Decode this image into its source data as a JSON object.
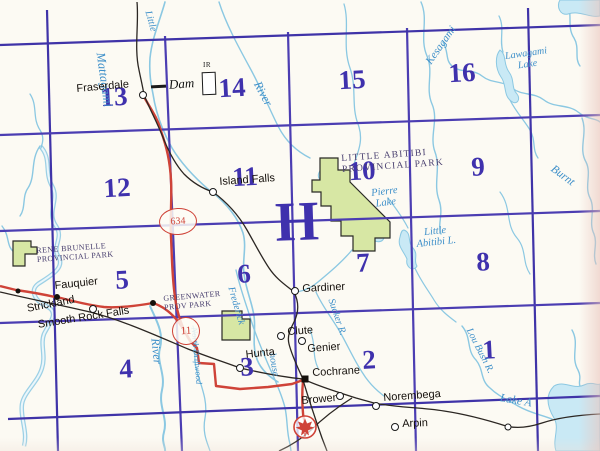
{
  "map": {
    "block_letter": "H",
    "grid_numbers": [
      {
        "label": "13",
        "x": 114,
        "y": 97
      },
      {
        "label": "14",
        "x": 232,
        "y": 88
      },
      {
        "label": "15",
        "x": 352,
        "y": 80
      },
      {
        "label": "16",
        "x": 462,
        "y": 73
      },
      {
        "label": "12",
        "x": 117,
        "y": 188
      },
      {
        "label": "11",
        "x": 245,
        "y": 177
      },
      {
        "label": "10",
        "x": 362,
        "y": 171
      },
      {
        "label": "9",
        "x": 478,
        "y": 167
      },
      {
        "label": "5",
        "x": 122,
        "y": 280
      },
      {
        "label": "6",
        "x": 244,
        "y": 274
      },
      {
        "label": "7",
        "x": 363,
        "y": 263
      },
      {
        "label": "8",
        "x": 483,
        "y": 262
      },
      {
        "label": "4",
        "x": 126,
        "y": 369
      },
      {
        "label": "3",
        "x": 247,
        "y": 367
      },
      {
        "label": "2",
        "x": 369,
        "y": 360
      },
      {
        "label": "1",
        "x": 489,
        "y": 350
      }
    ],
    "towns": [
      {
        "name": "Fraserdale",
        "dx": 143,
        "dy": 95,
        "marker": "open",
        "lx": 76,
        "ly": 83,
        "rot": -5
      },
      {
        "name": "Island Falls",
        "dx": 213,
        "dy": 192,
        "marker": "open",
        "lx": 219,
        "ly": 176,
        "rot": -4
      },
      {
        "name": "Gardiner",
        "dx": 295,
        "dy": 291,
        "marker": "open",
        "lx": 302,
        "ly": 283,
        "rot": -3
      },
      {
        "name": "Fauquier",
        "dx": 57,
        "dy": 297,
        "marker": "solid",
        "lx": 54,
        "ly": 280,
        "rot": -6
      },
      {
        "name": "Strickland",
        "dx": 93,
        "dy": 309,
        "marker": "open",
        "lx": 26,
        "ly": 303,
        "rot": -11
      },
      {
        "name": "Smooth Rock Falls",
        "dx": 153,
        "dy": 303,
        "marker": "solid",
        "lx": 37,
        "ly": 319,
        "rot": -9
      },
      {
        "name": "Hunta",
        "dx": 240,
        "dy": 368,
        "marker": "open",
        "lx": 245,
        "ly": 349,
        "rot": -6
      },
      {
        "name": "Clute",
        "dx": 281,
        "dy": 336,
        "marker": "open",
        "lx": 287,
        "ly": 326,
        "rot": -4
      },
      {
        "name": "Genier",
        "dx": 302,
        "dy": 341,
        "marker": "open",
        "lx": 307,
        "ly": 343,
        "rot": -4
      },
      {
        "name": "Cochrane",
        "dx": 305,
        "dy": 379,
        "marker": "square",
        "lx": 312,
        "ly": 367,
        "rot": -3
      },
      {
        "name": "Brower",
        "dx": 340,
        "dy": 396,
        "marker": "open",
        "lx": 301,
        "ly": 395,
        "rot": -5
      },
      {
        "name": "Norembega",
        "dx": 376,
        "dy": 406,
        "marker": "open",
        "lx": 383,
        "ly": 392,
        "rot": -4
      },
      {
        "name": "Arpin",
        "dx": 395,
        "dy": 427,
        "marker": "open",
        "lx": 402,
        "ly": 418,
        "rot": -2
      }
    ],
    "unlabeled_dots": [
      {
        "x": 18,
        "y": 291,
        "type": "solid"
      },
      {
        "x": 508,
        "y": 427,
        "type": "open"
      }
    ],
    "water_labels": [
      {
        "text": "Mattagami",
        "x": 100,
        "y": 46,
        "rot": 82,
        "size": 12.5
      },
      {
        "text": "Little",
        "x": 147,
        "y": 6,
        "rot": 74,
        "size": 10
      },
      {
        "text": "River",
        "x": 257,
        "y": 76,
        "rot": 62,
        "size": 12
      },
      {
        "text": "Kesagami",
        "x": 429,
        "y": 58,
        "rot": -55,
        "size": 11
      },
      {
        "lines": [
          "Lawagami",
          "Lake"
        ],
        "x": 506,
        "y": 52,
        "rot": -8,
        "size": 10
      },
      {
        "text": "Burnt",
        "x": 552,
        "y": 162,
        "rot": 36,
        "size": 11.5
      },
      {
        "lines": [
          "Pierre",
          "Lake"
        ],
        "x": 372,
        "y": 188,
        "rot": -7,
        "size": 10.5
      },
      {
        "lines": [
          "Little",
          "Abitibi L."
        ],
        "x": 416,
        "y": 228,
        "rot": -6,
        "size": 10.5
      },
      {
        "text": "River",
        "x": 155,
        "y": 332,
        "rot": 84,
        "size": 12
      },
      {
        "text": "Frederick",
        "x": 230,
        "y": 282,
        "rot": 74,
        "size": 10
      },
      {
        "text": "house",
        "x": 271,
        "y": 348,
        "rot": 80,
        "size": 10
      },
      {
        "text": "Sucker R.",
        "x": 330,
        "y": 294,
        "rot": 71,
        "size": 10
      },
      {
        "text": "North Driftwood",
        "x": 194,
        "y": 323,
        "rot": 85,
        "size": 8.5
      },
      {
        "text": "Lou Bush R.",
        "x": 468,
        "y": 324,
        "rot": 63,
        "size": 10
      },
      {
        "text": "Lake A",
        "x": 500,
        "y": 392,
        "rot": 10,
        "size": 11.5
      }
    ],
    "park_labels": [
      {
        "lines": [
          "RENE BRUNELLE",
          "PROVINCIAL PARK"
        ],
        "x": 36,
        "y": 246,
        "size": 8,
        "rot": -4,
        "ls": 0.4
      },
      {
        "lines": [
          "GREENWATER",
          "PROV PARK"
        ],
        "x": 163,
        "y": 294,
        "size": 8,
        "rot": -5,
        "ls": 0.4
      },
      {
        "lines": [
          "LITTLE ABITIBI",
          "PROVINCIAL PARK"
        ],
        "x": 341,
        "y": 154,
        "size": 9.5,
        "rot": -4,
        "ls": 1.2
      }
    ],
    "route_shields": [
      {
        "number": "634",
        "x": 159,
        "y": 208,
        "w": 36,
        "h": 25,
        "font": 10
      },
      {
        "number": "11",
        "x": 172,
        "y": 317,
        "w": 26,
        "h": 26,
        "font": 11
      }
    ],
    "symbols": {
      "dam": {
        "label": "Dam"
      },
      "ir": {
        "label": "IR"
      },
      "maple_leaf": "maple-leaf-marker"
    }
  },
  "colors": {
    "grid": "#4b3db2",
    "grid_thick": "#3f33a8",
    "number": "#3f31ad",
    "water": "#8bc8e2",
    "water_fill": "#c9e9f5",
    "water_text": "#3d8fc9",
    "park_fill": "#d7e7a4",
    "park_text": "#4a4070",
    "road": "#cf4338",
    "rail": "#2b2622",
    "town_text": "#15100c",
    "paper": "#fcfaf3"
  }
}
